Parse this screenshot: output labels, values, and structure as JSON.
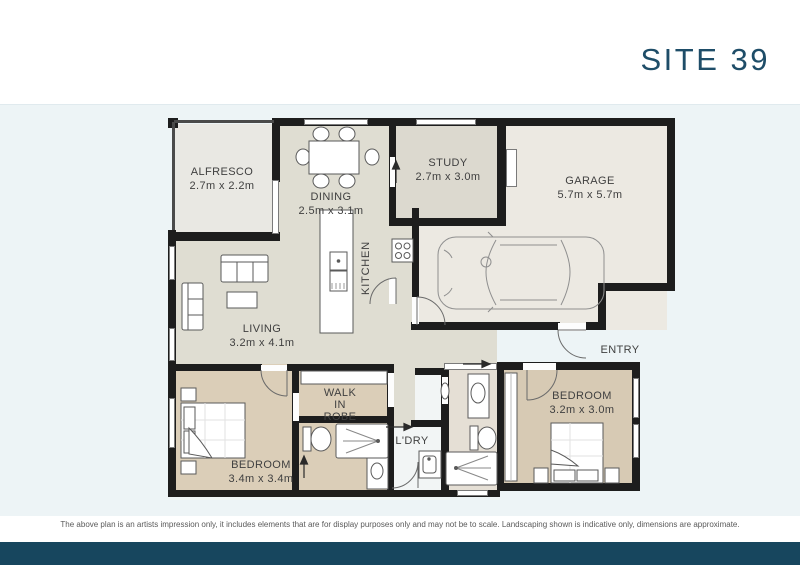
{
  "header": {
    "title": "SITE 39"
  },
  "plan": {
    "rooms": {
      "alfresco": {
        "name": "ALFRESCO",
        "dims": "2.7m x 2.2m"
      },
      "dining": {
        "name": "DINING",
        "dims": "2.5m x 3.1m"
      },
      "study": {
        "name": "STUDY",
        "dims": "2.7m x 3.0m"
      },
      "garage": {
        "name": "GARAGE",
        "dims": "5.7m x 5.7m"
      },
      "kitchen": {
        "name": "KITCHEN"
      },
      "living": {
        "name": "LIVING",
        "dims": "3.2m x 4.1m"
      },
      "entry": {
        "name": "ENTRY"
      },
      "bedroom_rear": {
        "name": "BEDROOM",
        "dims": "3.2m x 3.0m"
      },
      "walk_in_robe": {
        "line1": "WALK",
        "line2": "IN",
        "line3": "ROBE"
      },
      "laundry": {
        "name": "L'DRY"
      },
      "bedroom_main": {
        "name": "BEDROOM",
        "dims": "3.4m x 3.4m"
      }
    }
  },
  "footer": {
    "disclaimer": "The above plan is an artists impression only, it includes elements that are for display purposes only and may not be to scale. Landscaping shown is indicative only, dimensions are approximate."
  },
  "colors": {
    "accent": "#1e4d68",
    "footer_bar": "#17465e",
    "wall": "#1d1d1d",
    "floor_living": "#dfddd2",
    "floor_bedroom": "#dbceb8",
    "floor_garage": "#ece9e2"
  }
}
